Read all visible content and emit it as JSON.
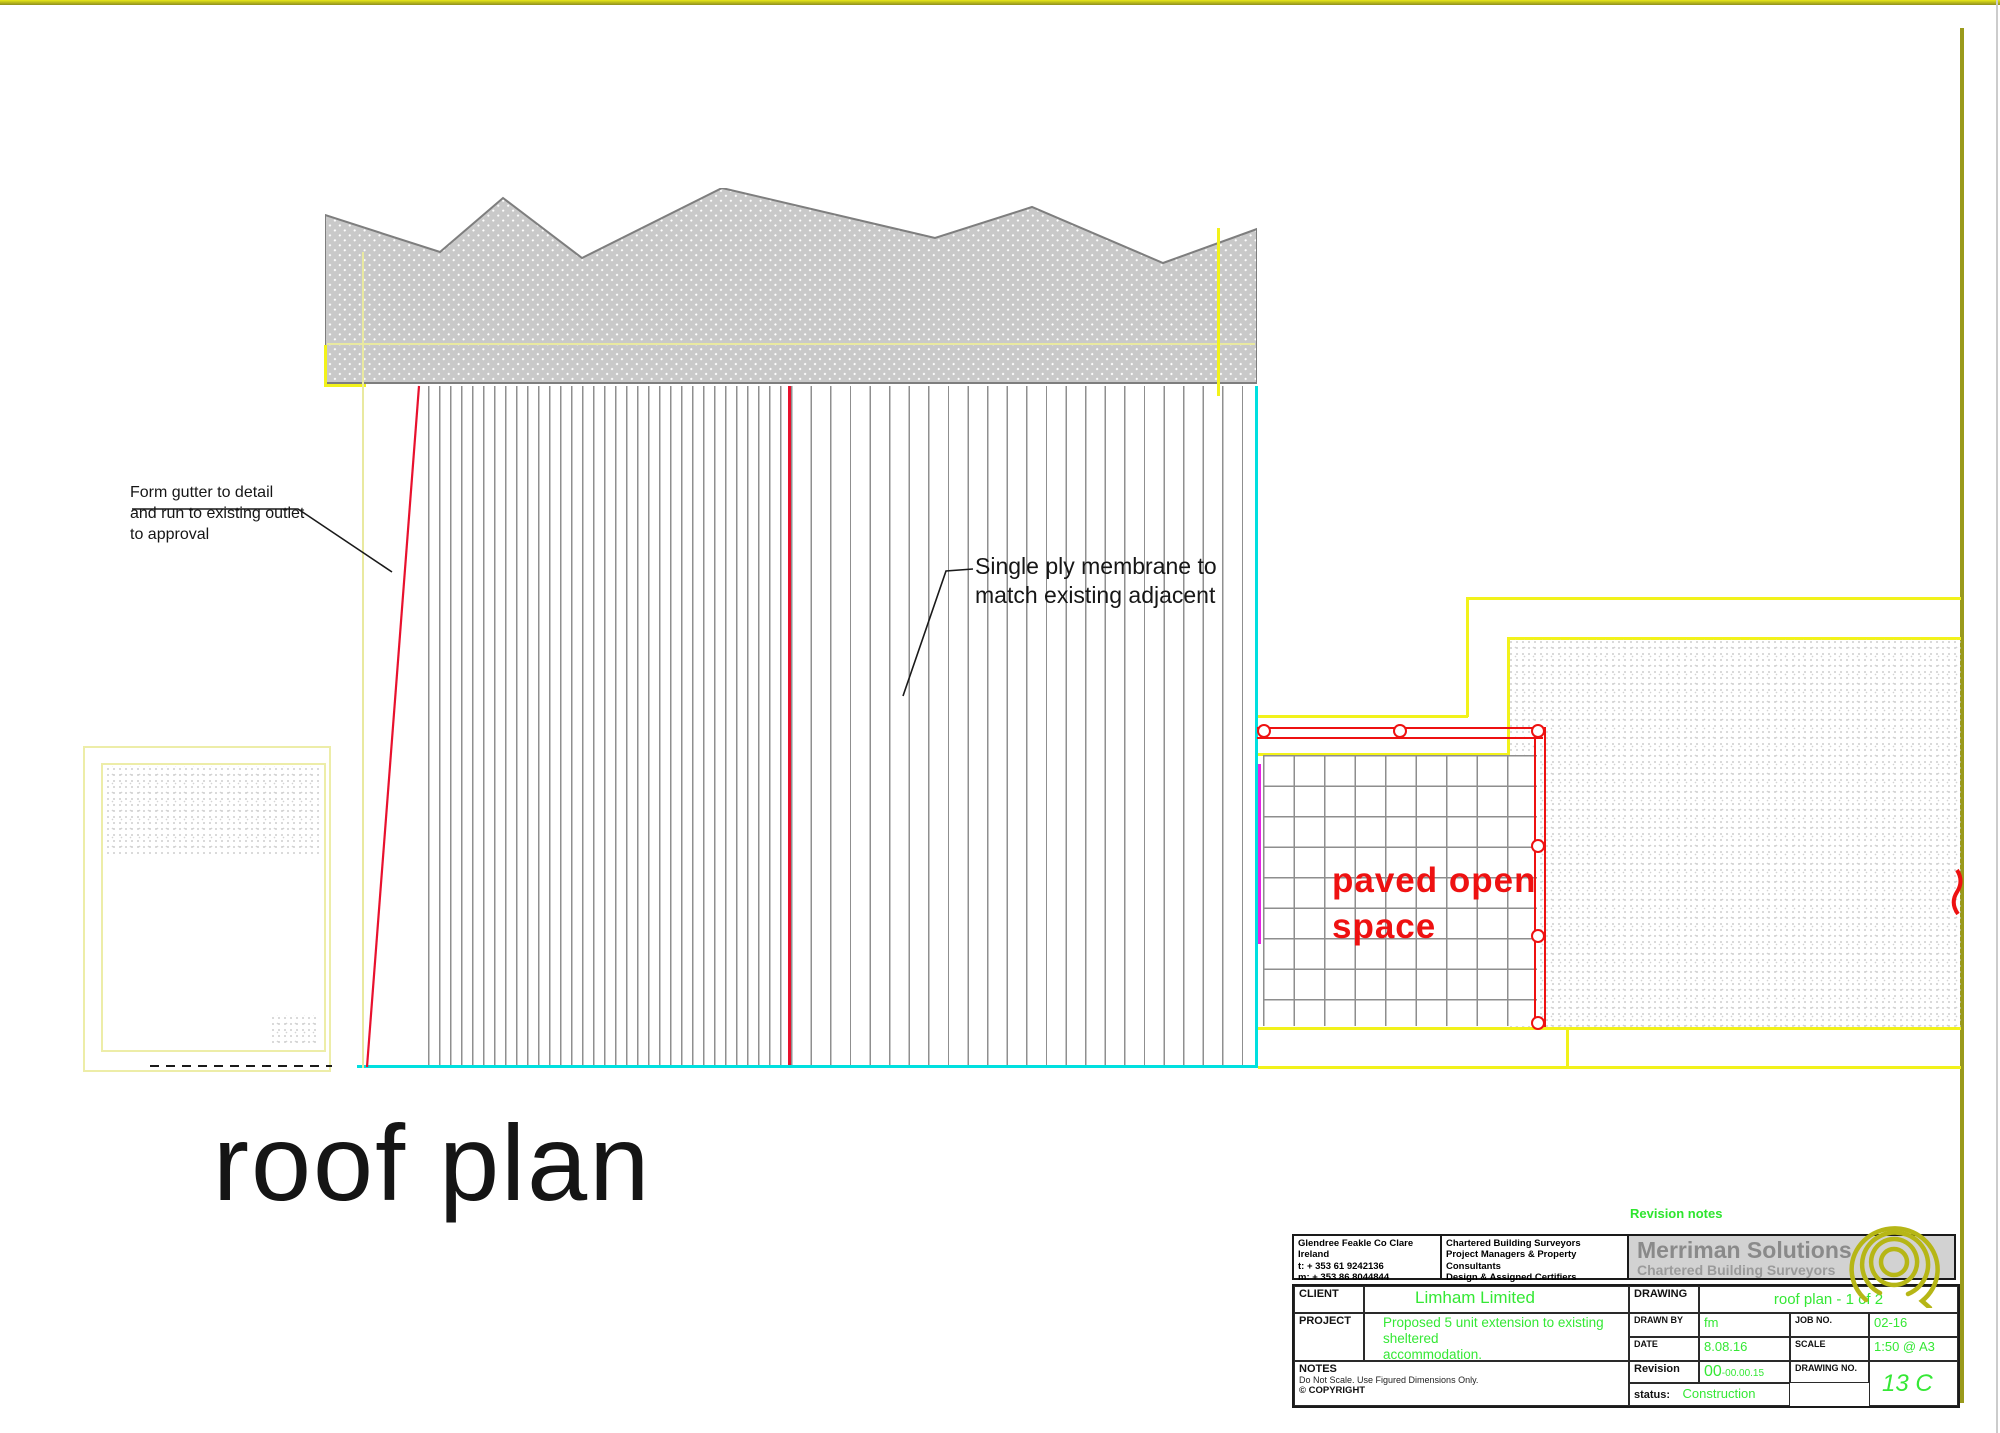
{
  "sheet": {
    "background": "#ffffff",
    "border_color": "#a8a818"
  },
  "drawing": {
    "title": "roof plan",
    "notes": {
      "gutter": {
        "lines": [
          "Form gutter to detail",
          "and run to existing outlet",
          "to approval"
        ]
      },
      "membrane": {
        "lines": [
          "Single ply membrane to",
          "match existing adjacent"
        ]
      },
      "paved": {
        "lines": [
          "paved open",
          "space"
        ]
      }
    }
  },
  "revision_notes_label": "Revision notes",
  "title_block": {
    "contact": {
      "lines": [
        "Glendree Feakle Co Clare Ireland",
        "t: + 353 61 9242136",
        "m: + 353 86 8044844",
        "e: fergusjbm@gmail.com"
      ]
    },
    "services": {
      "lines": [
        "Chartered Building Surveyors",
        "Project Managers & Property Consultants",
        "Design & Assigned Certifiers",
        "Renewable & Sustainable energy advice"
      ]
    },
    "company": {
      "name": "Merriman Solutions",
      "subtitle": "Chartered Building Surveyors"
    },
    "client": {
      "label": "CLIENT",
      "value": "Limham Limited"
    },
    "drawing": {
      "label": "DRAWING",
      "value": "roof plan - 1 of 2"
    },
    "project": {
      "label": "PROJECT",
      "lines": [
        "Proposed 5 unit extension to existing sheltered",
        "accommodation.",
        "11 Merville Avenue, Fairview, Dublin 3"
      ]
    },
    "drawn_by": {
      "label": "DRAWN BY",
      "value": "fm"
    },
    "job_no": {
      "label": "JOB NO.",
      "value": "02-16"
    },
    "date": {
      "label": "DATE",
      "value": "8.08.16"
    },
    "scale": {
      "label": "SCALE",
      "value": "1:50 @ A3"
    },
    "revision": {
      "label": "Revision",
      "value_main": "00",
      "value_suffix": "-00.00.15"
    },
    "drawing_no": {
      "label": "DRAWING NO.",
      "value": "13 C"
    },
    "notes": {
      "label": "NOTES",
      "line": "Do Not Scale.  Use Figured Dimensions Only.",
      "copyright": "© COPYRIGHT"
    },
    "status": {
      "label": "status:",
      "value": "Construction"
    }
  },
  "colors": {
    "page_border_olive": "#9a9a1c",
    "construction_yellow": "#f2f21a",
    "pale_yellow": "#e9e9a0",
    "red": "#ee1111",
    "crimson_roof_line": "#e8112d",
    "cyan": "#00e0e0",
    "magenta": "#e623e6",
    "green_text": "#35e835",
    "company_gray": "#8a8a8a",
    "hatch_gray": "#c9c9c9",
    "logo_olive": "#b6b616"
  }
}
